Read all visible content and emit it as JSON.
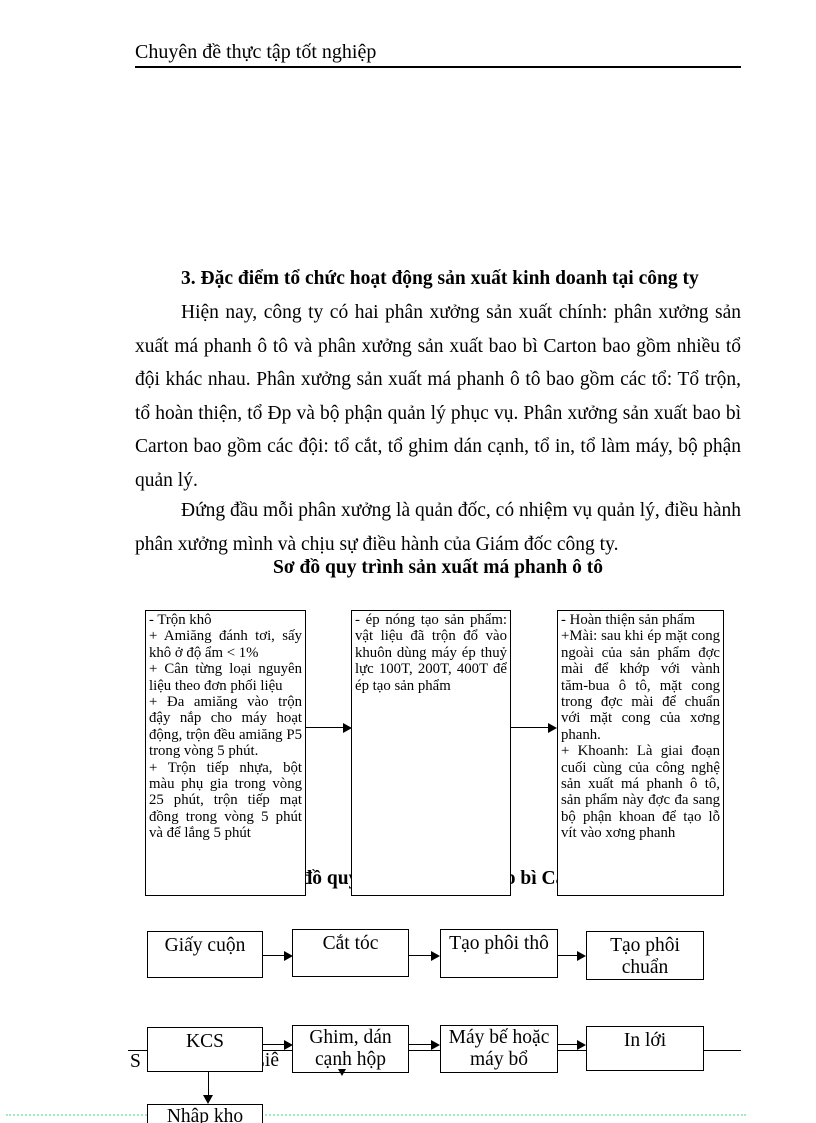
{
  "header": {
    "title": "Chuyên đề thực tập tốt nghiệp"
  },
  "section": {
    "heading": "3. Đặc điểm tổ chức hoạt động sản xuất kinh doanh tại công ty"
  },
  "paragraphs": [
    "Hiện nay, công ty có hai phân xưởng sản xuất chính: phân xưởng sản xuất má phanh ô tô và phân xưởng sản xuất bao bì Carton bao gồm nhiều tổ đội khác nhau. Phân xưởng sản xuất má phanh ô tô bao gồm các tổ: Tổ trộn, tổ hoàn thiện, tổ Đp và bộ phận quản lý phục vụ. Phân xưởng sản xuất bao bì Carton bao gồm các đội: tổ cắt, tổ ghim dán cạnh, tổ in, tổ làm máy, bộ phận quản lý.",
    "Đứng đầu mỗi phân xưởng là quản đốc, có nhiệm vụ quản lý, điều hành phân xưởng mình và chịu sự điều hành của Giám đốc công ty."
  ],
  "diagram_ma_phanh": {
    "title": "Sơ đồ quy trình sản xuất má phanh ô tô",
    "boxes": [
      {
        "lines": [
          "- Trộn khô",
          "+ Amiăng đánh tơi, sấy khô ở độ ẩm < 1%",
          "+ Cân từng loại nguyên liệu theo đơn phối liệu",
          "+ Đa amiăng vào trộn đậy nắp cho máy hoạt động, trộn đều amiăng P5 trong vòng 5 phút.",
          "+ Trộn tiếp nhựa, bột màu phụ gia trong vòng 25 phút, trộn tiếp mạt đồng trong vòng 5 phút và để lắng 5 phút"
        ]
      },
      {
        "lines": [
          "- ép nóng tạo sản phẩm: vật liệu đã trộn đổ vào khuôn dùng máy ép thuỷ lực 100T, 200T, 400T để ép tạo sản phẩm"
        ]
      },
      {
        "lines": [
          "- Hoàn thiện sản phẩm",
          "+Mài: sau khi ép mặt cong ngoài của sản phẩm đợc mài để khớp với vành tăm-bua ô tô, mặt cong trong đợc mài để chuẩn với mặt cong của xơng phanh.",
          "+ Khoanh: Là giai đoạn cuối cùng của công nghệ sản xuất má phanh ô tô, sản phẩm này đợc đa sang bộ phận khoan để tạo lỗ vít vào xơng phanh"
        ]
      }
    ]
  },
  "diagram_bao_bi": {
    "title_partially_hidden": "Sơ đồ quy trình sản xuất bao bì Carton",
    "row1": [
      "Giấy cuộn",
      "Cắt tóc",
      "Tạo phôi thô",
      "Tạo phôi chuẩn"
    ],
    "row2": [
      "KCS",
      "Ghim, dán cạnh hộp",
      "Máy bế hoặc máy bổ",
      "In lới"
    ],
    "bottom_box": "Nhập kho"
  },
  "footer": {
    "fragments": [
      "S",
      "Liê",
      "1"
    ]
  },
  "colors": {
    "text": "#000000",
    "dotted_guide": "#9ceebb"
  }
}
